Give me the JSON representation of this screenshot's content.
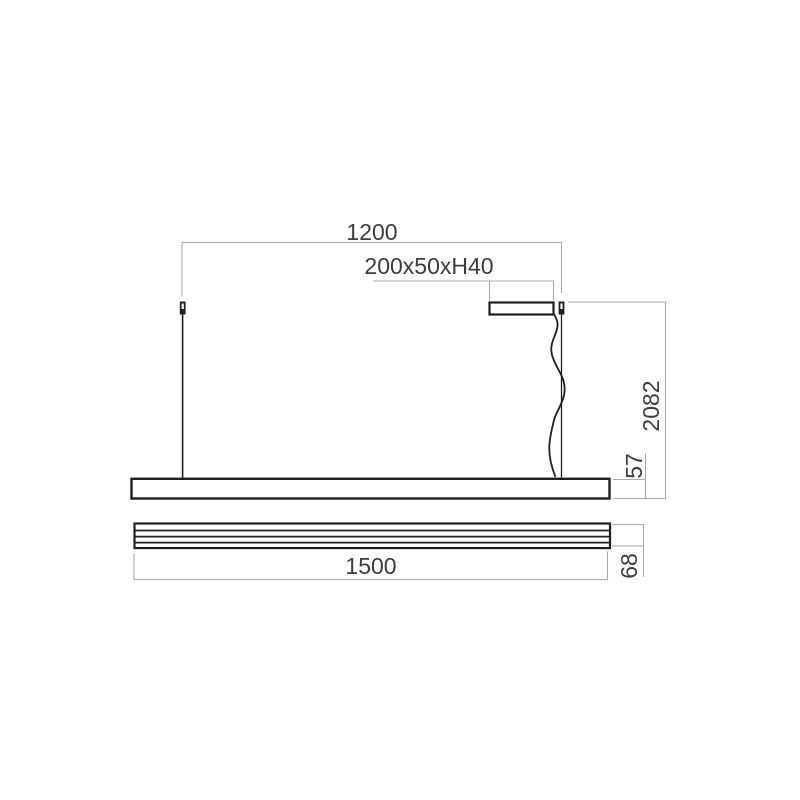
{
  "drawing": {
    "labels": {
      "suspension_spacing": "1200",
      "canopy_size": "200x50xH40",
      "overall_height": "2082",
      "body_height_side": "57",
      "body_length": "1500",
      "body_height_front": "68"
    },
    "colors": {
      "object_line": "#1f1f1f",
      "dimension_line": "#a9a9a9",
      "label_text": "#3c3c3c",
      "background": "#ffffff"
    }
  }
}
